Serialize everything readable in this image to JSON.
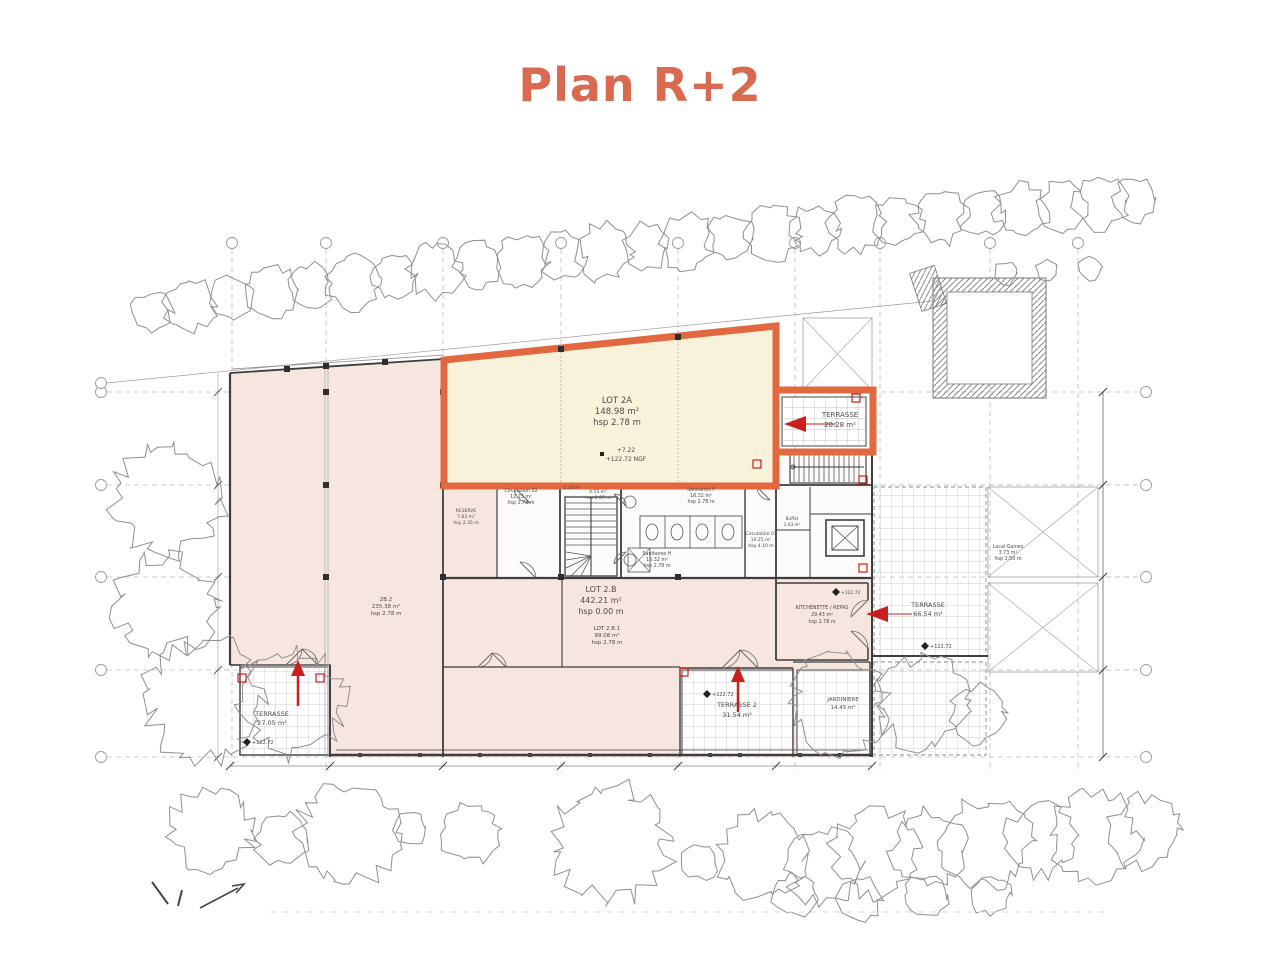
{
  "title": "Plan R+2",
  "colors": {
    "accent": "#d96a4f",
    "lot_border": "#e2693f",
    "lot_fill": "#f9f2da",
    "room_fill": "#f7e6e0",
    "red": "#c9201d",
    "wall": "#3d3d3d",
    "line": "#9a9a9a",
    "tree": "#8f8f8f",
    "grid": "#bcbcbc"
  },
  "plan": {
    "labels": [
      {
        "text": "LOT 2A",
        "x": 617,
        "y": 403,
        "size": 8.5
      },
      {
        "text": "148.98 m²",
        "x": 617,
        "y": 414,
        "size": 8.5
      },
      {
        "text": "hsp 2.78 m",
        "x": 617,
        "y": 425,
        "size": 8.5
      },
      {
        "text": "+7.22",
        "x": 626,
        "y": 452,
        "size": 6
      },
      {
        "text": "+122.72 NGF",
        "x": 626,
        "y": 461,
        "size": 6
      },
      {
        "text": "TERRASSE",
        "x": 840,
        "y": 417,
        "size": 7
      },
      {
        "text": "20.28 m²",
        "x": 840,
        "y": 427,
        "size": 7
      },
      {
        "text": "LOT 2.B",
        "x": 601,
        "y": 592,
        "size": 8
      },
      {
        "text": "442.21 m²",
        "x": 601,
        "y": 603,
        "size": 8
      },
      {
        "text": "hsp 0.00 m",
        "x": 601,
        "y": 614,
        "size": 8
      },
      {
        "text": "LOT 2.B.1",
        "x": 607,
        "y": 630,
        "size": 5.5
      },
      {
        "text": "99.08 m²",
        "x": 607,
        "y": 637,
        "size": 5.5
      },
      {
        "text": "hsp 2.78 m",
        "x": 607,
        "y": 644,
        "size": 5.5
      },
      {
        "text": "2B.2",
        "x": 386,
        "y": 601,
        "size": 5.5
      },
      {
        "text": "235.38 m²",
        "x": 386,
        "y": 608,
        "size": 5.5
      },
      {
        "text": "hsp 2.78 m",
        "x": 386,
        "y": 615,
        "size": 5.5
      },
      {
        "text": "TERRASSE",
        "x": 272,
        "y": 716,
        "size": 6.5
      },
      {
        "text": "27.05 m²",
        "x": 272,
        "y": 725,
        "size": 6.5
      },
      {
        "text": "+122.72",
        "x": 252,
        "y": 744,
        "size": 5,
        "align": "start"
      },
      {
        "text": "TERRASSE 2",
        "x": 737,
        "y": 707,
        "size": 6.5
      },
      {
        "text": "31.54 m²",
        "x": 737,
        "y": 717,
        "size": 6.5
      },
      {
        "text": "+122.72",
        "x": 712,
        "y": 696,
        "size": 5,
        "align": "start"
      },
      {
        "text": "JARDINIERE",
        "x": 843,
        "y": 701,
        "size": 5.5
      },
      {
        "text": "14.45 m²",
        "x": 843,
        "y": 709,
        "size": 5.5
      },
      {
        "text": "TERRASSE",
        "x": 928,
        "y": 607,
        "size": 6.5
      },
      {
        "text": "66.54 m²",
        "x": 928,
        "y": 616,
        "size": 6.5
      },
      {
        "text": "+122.72",
        "x": 930,
        "y": 648,
        "size": 5,
        "align": "start"
      },
      {
        "text": "KITCHENETTE / REPAS",
        "x": 822,
        "y": 609,
        "size": 4.8
      },
      {
        "text": "29.43 m²",
        "x": 822,
        "y": 616,
        "size": 4.8
      },
      {
        "text": "hsp 2.78 m",
        "x": 822,
        "y": 623,
        "size": 4.8
      },
      {
        "text": "+122.72",
        "x": 841,
        "y": 594,
        "size": 4.5,
        "align": "start"
      },
      {
        "text": "Circulation 02",
        "x": 521,
        "y": 492,
        "size": 4.8
      },
      {
        "text": "12.23 m²",
        "x": 521,
        "y": 498,
        "size": 4.8
      },
      {
        "text": "hsp 2.78 m",
        "x": 521,
        "y": 504,
        "size": 4.8
      },
      {
        "text": "RESERVE",
        "x": 466,
        "y": 512,
        "size": 4.5
      },
      {
        "text": "7.63 m²",
        "x": 466,
        "y": 518,
        "size": 4.5
      },
      {
        "text": "hsp 2.35 m",
        "x": 466,
        "y": 524,
        "size": 4.5
      },
      {
        "text": "4.55 m²",
        "x": 598,
        "y": 493,
        "size": 4.5
      },
      {
        "text": "hsp 2.07 m",
        "x": 598,
        "y": 499,
        "size": 4.5
      },
      {
        "text": "2.28 m²",
        "x": 572,
        "y": 489,
        "size": 4.2
      },
      {
        "text": "Sanitaires F",
        "x": 701,
        "y": 491,
        "size": 4.8
      },
      {
        "text": "16.32 m²",
        "x": 701,
        "y": 497,
        "size": 4.8
      },
      {
        "text": "hsp 2.78 m",
        "x": 701,
        "y": 503,
        "size": 4.8
      },
      {
        "text": "Sanitaires H",
        "x": 657,
        "y": 555,
        "size": 4.8
      },
      {
        "text": "15.32 m²",
        "x": 657,
        "y": 561,
        "size": 4.8
      },
      {
        "text": "hsp 2.78 m",
        "x": 657,
        "y": 567,
        "size": 4.8
      },
      {
        "text": "Circulation 01",
        "x": 761,
        "y": 535,
        "size": 4.5
      },
      {
        "text": "10.25 m²",
        "x": 761,
        "y": 541,
        "size": 4.5
      },
      {
        "text": "hsp 4.10 m",
        "x": 761,
        "y": 547,
        "size": 4.5
      },
      {
        "text": "Local Gaines",
        "x": 1008,
        "y": 548,
        "size": 4.8
      },
      {
        "text": "3.73 m²",
        "x": 1008,
        "y": 554,
        "size": 4.8
      },
      {
        "text": "hsp 2.50 m",
        "x": 1008,
        "y": 560,
        "size": 4.8
      },
      {
        "text": "Buffet",
        "x": 792,
        "y": 520,
        "size": 4.2
      },
      {
        "text": "2.43 m²",
        "x": 792,
        "y": 526,
        "size": 4.2
      }
    ]
  }
}
